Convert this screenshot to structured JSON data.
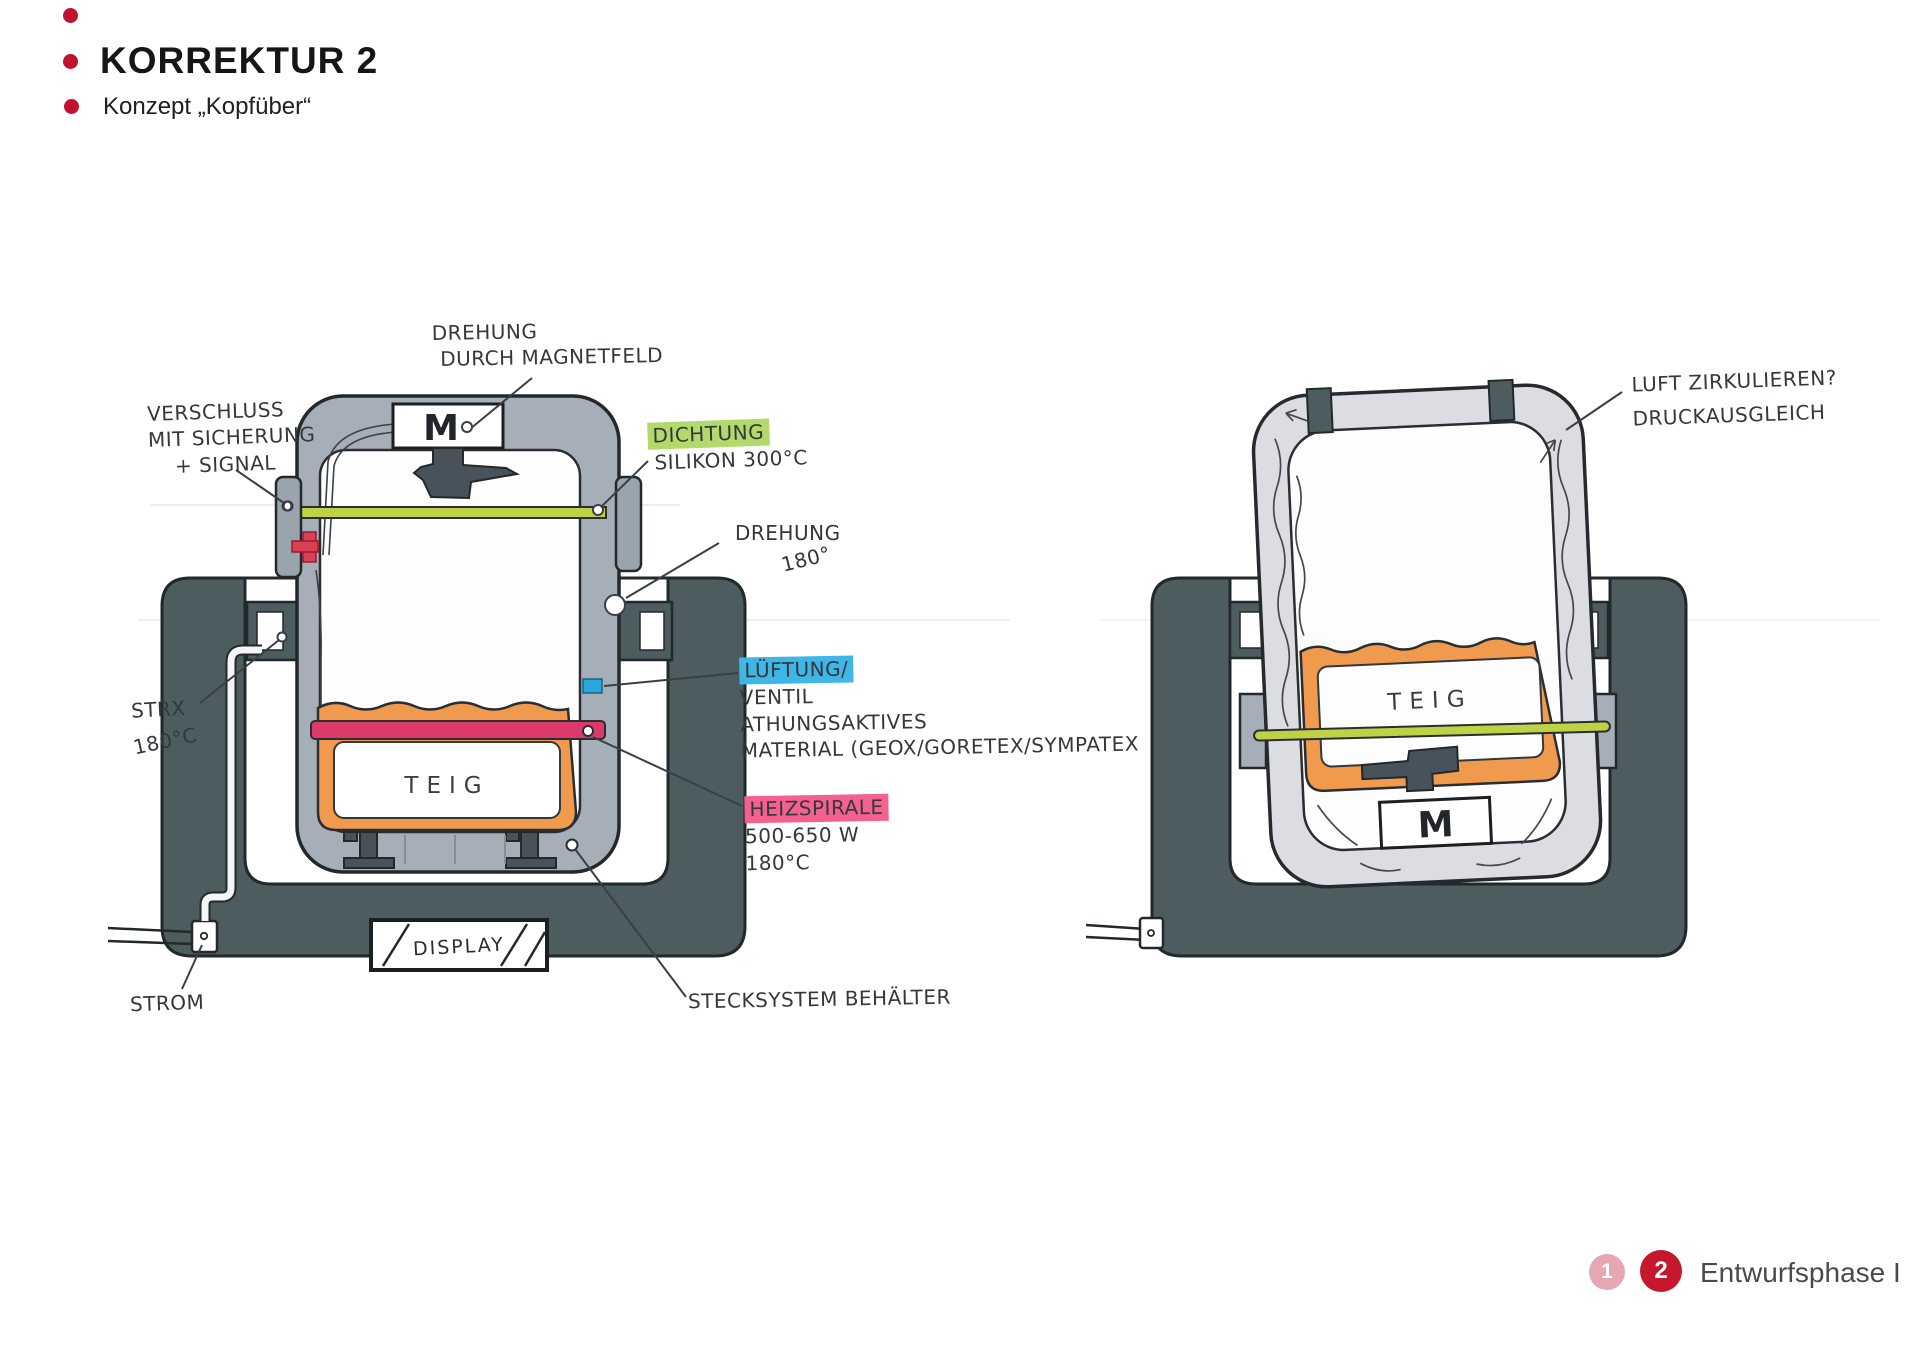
{
  "header": {
    "title": "KORREKTUR 2",
    "subtitle": "Konzept „Kopfüber“"
  },
  "left": {
    "machine_label": "M",
    "dough_label": "TEIG",
    "display_label": "DISPLAY",
    "labels": {
      "magnet": {
        "l1": "DREHUNG",
        "l2": "DURCH MAGNETFELD"
      },
      "verschluss": {
        "l1": "VERSCHLUSS",
        "l2": "MIT SICHERUNG",
        "l3": "+ SIGNAL"
      },
      "dichtung": {
        "hl": "DICHTUNG",
        "l2": "SILIKON 300°C"
      },
      "drehung": {
        "l1": "DREHUNG",
        "l2": "180°"
      },
      "lueftung": {
        "hl": "LÜFTUNG/",
        "l2": "VENTIL",
        "l3": "ATHUNGSAKTIVES",
        "l4": "MATERIAL (GEOX/GORETEX/SYMPATEX"
      },
      "heizspirale": {
        "hl": "HEIZSPIRALE",
        "l2": "500-650 W",
        "l3": "180°C"
      },
      "strx": {
        "l1": "STRX",
        "l2": "180°C"
      },
      "strom": "STROM",
      "stecksystem": "STECKSYSTEM BEHÄLTER"
    }
  },
  "right": {
    "machine_label": "M",
    "dough_label": "TEIG",
    "labels": {
      "luft": {
        "l1": "LUFT ZIRKULIEREN?",
        "l2": "DRUCKAUSGLEICH"
      }
    }
  },
  "footer": {
    "page1": "1",
    "page2": "2",
    "phase": "Entwurfsphase I"
  },
  "colors": {
    "accent_red": "#c31230",
    "page1_pink": "#e5a8b2",
    "page2_red": "#c5182c",
    "highlight_green": "#b4d96b",
    "highlight_blue": "#3fb6e6",
    "highlight_pink": "#f4618f",
    "seal_green": "#bfd243",
    "heater_pink": "#dd3a6c",
    "container_orange": "#f09a4e",
    "stand_dark": "#4d5c5e",
    "body_gray": "#a6afb7",
    "shell_light": "#dcdde2",
    "ink": "#33383d"
  }
}
